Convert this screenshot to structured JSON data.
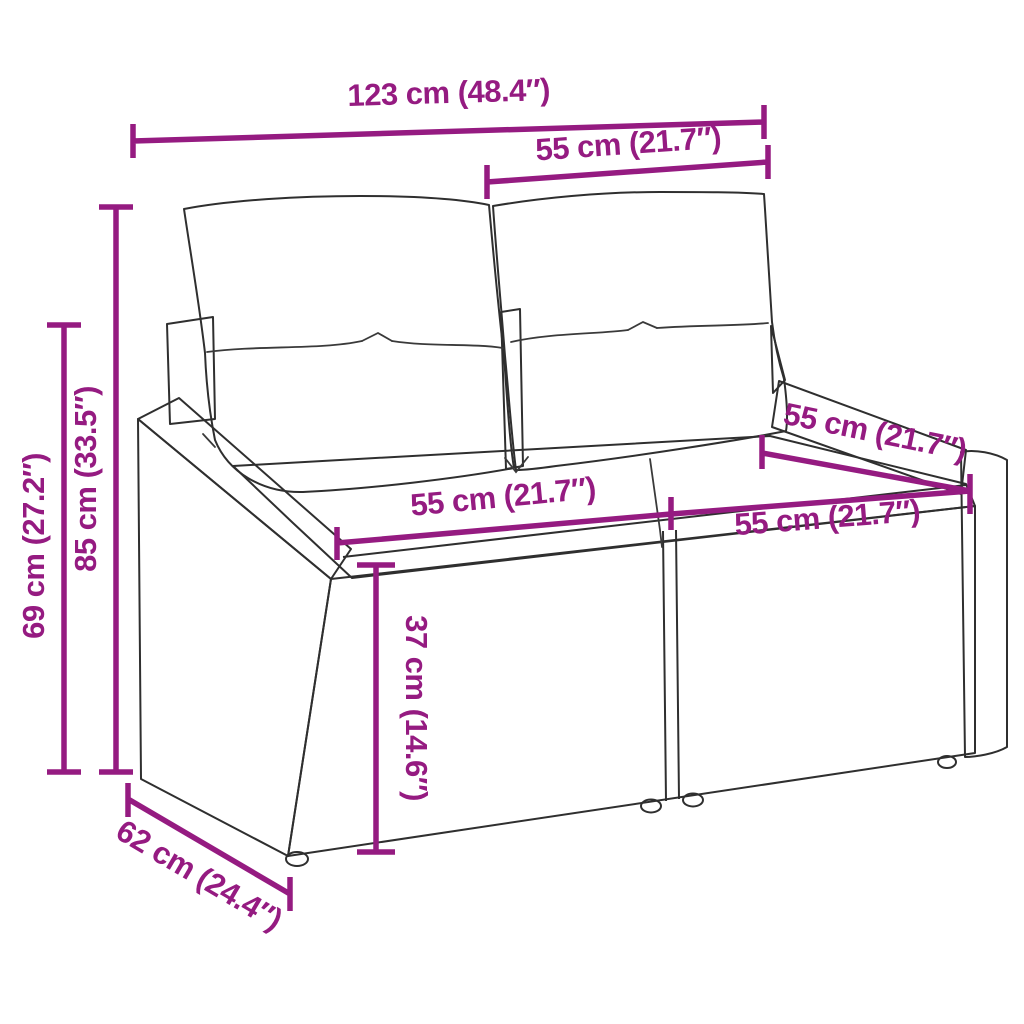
{
  "diagram": {
    "type": "product-dimension-diagram",
    "subject": "rattan-two-seater-garden-sofa-with-cushions",
    "accent_color": "#951b81",
    "artwork_line_color": "#2f2f2f",
    "background_color": "#ffffff",
    "dimensions": {
      "overall_width": "123 cm (48.4″)",
      "back_section_width": "55 cm (21.7″)",
      "overall_height": "85 cm (33.5″)",
      "arm_height": "69 cm (27.2″)",
      "seat_width_left": "55 cm (21.7″)",
      "seat_width_right": "55 cm (21.7″)",
      "seat_depth": "55 cm (21.7″)",
      "seat_height": "37 cm (14.6″)",
      "overall_depth": "62 cm (24.4″)"
    }
  }
}
